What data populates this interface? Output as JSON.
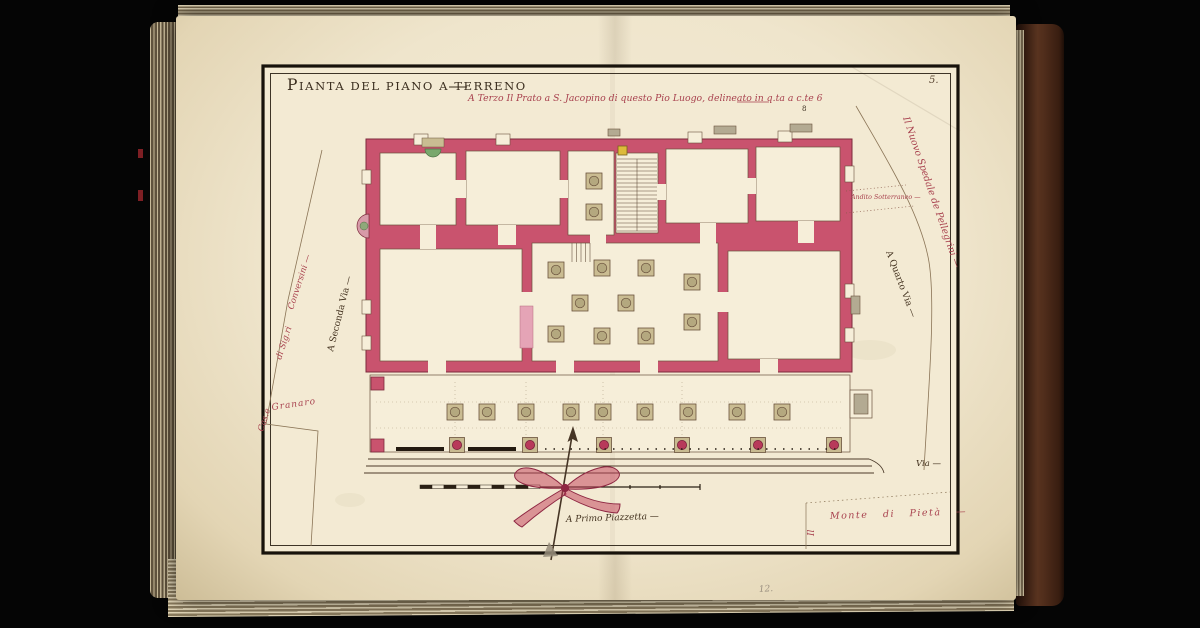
{
  "plate": {
    "title_initial": "P",
    "title_rest": "IANTA DEL PIANO A TERRENO",
    "caption": "A Terzo Il Prato a S. Jacopino di questo Pio Luogo, delineato in q.ta a c.te 6",
    "page_number": "5.",
    "ink_mark": "8",
    "pencil_mark": "12."
  },
  "labels": {
    "street_left": "A Seconda Via —",
    "street_right": "A Quarto Via —",
    "neighbor_right": "Il Nuovo Spedale de Pellegrini —",
    "andito": "Andito Sotterraneo —",
    "conversini": "Conversini —",
    "sigri": "di Sig.ri",
    "case": "Cas.e",
    "granary": "Granaro",
    "piazzetta": "A Primo Piazzetta —",
    "monte_prefix": "Il",
    "monte": "Monte di Pietà —",
    "via": "Via —"
  },
  "drawing": {
    "subject": "ground-floor plan of a hospital building with portico",
    "north_arrow": "arrow with ribbon bow",
    "scale_bar": "graduated bar, unnumbered"
  },
  "colors": {
    "wall_crimson": "#c9536e",
    "wall_outline": "#7d2b3c",
    "red_ink": "#a8414e",
    "dark_ink": "#3a2d1e",
    "plate_paper": "#f3ead3",
    "pillar_tan": "#c9bc92",
    "gold_accent": "#ddba3a",
    "green_niche": "#79a86d",
    "cover_brown": "#5a3420",
    "background": "#050505"
  }
}
